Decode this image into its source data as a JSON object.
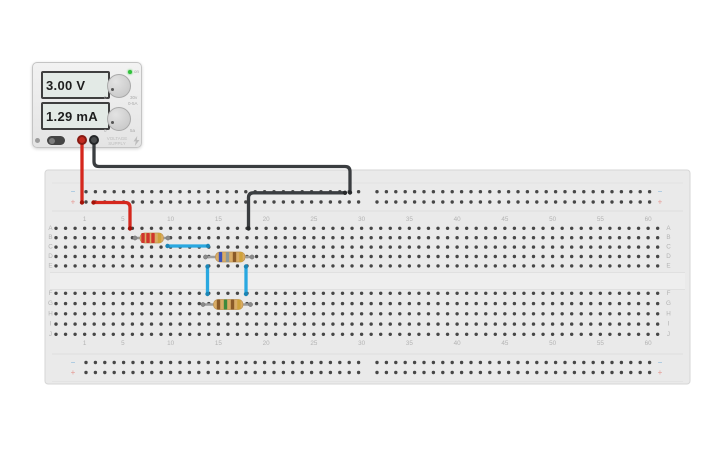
{
  "power_supply": {
    "voltage_display": "3.00 V",
    "current_display": "1.29 mA",
    "label_line1": "VOLTAGE",
    "label_line2": "SUPPLY",
    "led_label": "on",
    "knobs": {
      "voltage_min": "0",
      "voltage_max": "30v",
      "current_min": "0",
      "current_max": "5a",
      "current_range": "0-5A"
    }
  },
  "breadboard": {
    "column_numbers": [
      "1",
      "5",
      "10",
      "15",
      "20",
      "25",
      "30",
      "35",
      "40",
      "45",
      "50",
      "55",
      "60"
    ],
    "row_letters_top": [
      "A",
      "B",
      "C",
      "D",
      "E"
    ],
    "row_letters_bottom": [
      "F",
      "G",
      "H",
      "I",
      "J"
    ],
    "rail_negative_symbol": "−",
    "rail_positive_symbol": "+"
  },
  "components": {
    "resistors": [
      {
        "id": "R1",
        "value": "2.2 kΩ",
        "bands": [
          "red",
          "red",
          "red",
          "gold"
        ],
        "y": 238,
        "lead_x": [
          135,
          168
        ],
        "body_x": [
          140,
          163.5
        ],
        "band_x": [
          143,
          148,
          153,
          159.5
        ]
      },
      {
        "id": "R2",
        "value": "680 Ω",
        "bands": [
          "blue",
          "gray",
          "brown",
          "gold"
        ],
        "y": 257,
        "lead_x": [
          205.5,
          252
        ],
        "body_x": [
          215.5,
          245
        ],
        "band_x": [
          220.5,
          227.5,
          234.5,
          241
        ]
      },
      {
        "id": "R3",
        "value": "150 Ω",
        "bands": [
          "brown",
          "green",
          "brown",
          "gold"
        ],
        "y": 304.5,
        "lead_x": [
          203,
          250.5
        ],
        "body_x": [
          213.5,
          243
        ],
        "band_x": [
          218.5,
          225.5,
          232.5,
          239
        ]
      }
    ],
    "wires": [
      {
        "id": "red-supply-to-positive-rail",
        "color": "red",
        "points": [
          [
            82,
            141
          ],
          [
            82,
            202.5
          ]
        ]
      },
      {
        "id": "red-positive-rail-to-row-a",
        "color": "red",
        "points": [
          [
            93.5,
            202.5
          ],
          [
            130,
            202.5
          ],
          [
            130,
            228.5
          ]
        ]
      },
      {
        "id": "black-supply-to-negative-rail",
        "color": "black",
        "points": [
          [
            94,
            141
          ],
          [
            94,
            166.5
          ],
          [
            350,
            166.5
          ],
          [
            350,
            192.5
          ]
        ]
      },
      {
        "id": "black-negative-rail-to-row-a",
        "color": "black",
        "points": [
          [
            345,
            192.8
          ],
          [
            248.5,
            192.8
          ],
          [
            248.5,
            228.5
          ]
        ]
      },
      {
        "id": "blue-row-c-jumper",
        "color": "blue",
        "points": [
          [
            167.5,
            246
          ],
          [
            208,
            246
          ]
        ]
      },
      {
        "id": "blue-left-gap-jumper",
        "color": "blue",
        "points": [
          [
            207.5,
            266.5
          ],
          [
            207.5,
            294
          ]
        ]
      },
      {
        "id": "blue-right-gap-jumper",
        "color": "blue",
        "points": [
          [
            246,
            266.5
          ],
          [
            246,
            294
          ]
        ]
      }
    ]
  },
  "colors": {
    "board": "#eaeaea",
    "board_edge": "#d6d6d6",
    "dot": "#464646",
    "label": "#b3b3b3",
    "wire_red": "#d5271d",
    "wire_black": "#3a3d40",
    "wire_blue": "#29a8e0",
    "cap_red": "#a31208",
    "cap_black": "#26282a",
    "cap_blue": "#1b85b5",
    "lead": "#9c9c9c",
    "lead_cap": "#8b8b8b",
    "resistor_body": "#d9ac66",
    "resistor_body_edge": "#bd9352",
    "rail_negative": "#85b7dc",
    "rail_positive": "#e59a94",
    "band_colors": {
      "red": "#d0342c",
      "gold": "#cfa23b",
      "blue": "#3a4fb8",
      "gray": "#8d9898",
      "brown": "#8a5a28",
      "green": "#3f8a3c"
    }
  }
}
